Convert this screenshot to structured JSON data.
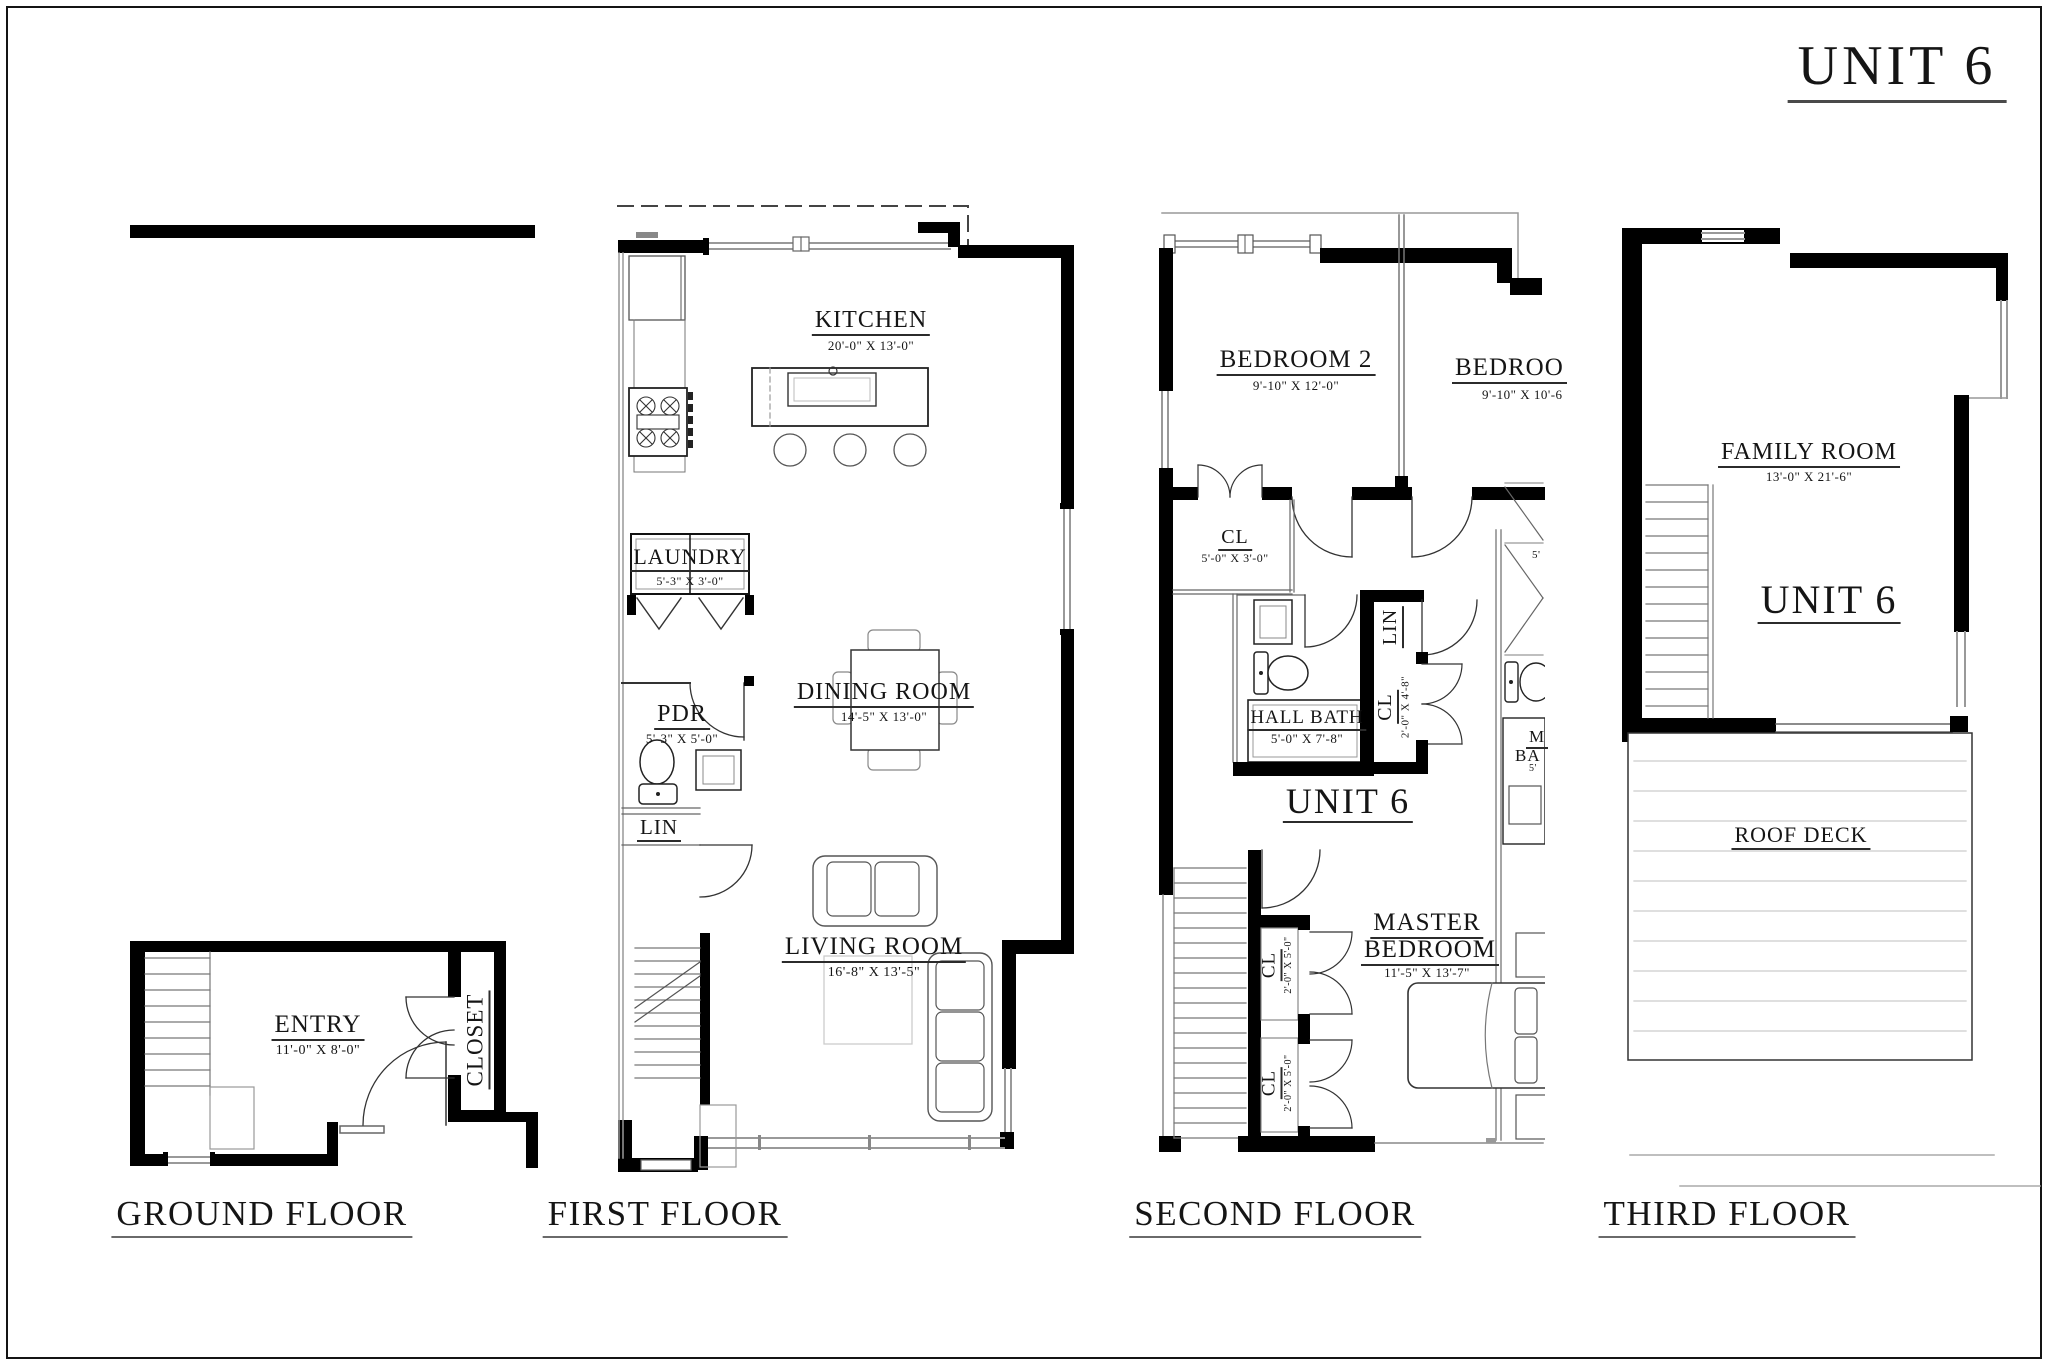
{
  "page": {
    "title": "UNIT 6"
  },
  "floors": {
    "ground": {
      "label": "GROUND FLOOR",
      "entry": {
        "name": "ENTRY",
        "dims": "11'-0\" X 8'-0\""
      },
      "closet": {
        "name": "CLOSET"
      }
    },
    "first": {
      "label": "FIRST FLOOR",
      "kitchen": {
        "name": "KITCHEN",
        "dims": "20'-0\" X 13'-0\""
      },
      "laundry": {
        "name": "LAUNDRY",
        "dims": "5'-3\" X 3'-0\""
      },
      "dining": {
        "name": "DINING ROOM",
        "dims": "14'-5\" X 13'-0\""
      },
      "powder": {
        "name": "PDR",
        "dims": "5'-3\" X 5'-0\""
      },
      "linen": {
        "name": "LIN"
      },
      "living": {
        "name": "LIVING ROOM",
        "dims": "16'-8\" X 13'-5\""
      }
    },
    "second": {
      "label": "SECOND FLOOR",
      "unit": "UNIT 6",
      "bedroom2": {
        "name": "BEDROOM 2",
        "dims": "9'-10\" X 12'-0\""
      },
      "bedroom3": {
        "name": "BEDROO",
        "dims": "9'-10\" X 10'-6"
      },
      "closet_hall": {
        "name": "CL",
        "dims": "5'-0\" X 3'-0\""
      },
      "hall_bath": {
        "name": "HALL BATH",
        "dims": "5'-0\" X 7'-8\""
      },
      "linen": {
        "name": "LIN"
      },
      "closet_mid": {
        "name": "CL",
        "dims": "2'-0\" X 4'-8\""
      },
      "master": {
        "line1": "MASTER",
        "line2": "BEDROOM",
        "dims": "11'-5\" X 13'-7\""
      },
      "closet_master1": {
        "name": "CL",
        "dims": "2'-0\" X 5'-0\""
      },
      "closet_master2": {
        "name": "CL",
        "dims": "2'-0\" X 5'-0\""
      },
      "master_bath_partial": {
        "line1": "M",
        "line2": "BA",
        "dim_top": "5'",
        "dim_bottom": "5'"
      }
    },
    "third": {
      "label": "THIRD FLOOR",
      "unit": "UNIT 6",
      "family": {
        "name": "FAMILY ROOM",
        "dims": "13'-0\" X 21'-6\""
      },
      "roof_deck": {
        "name": "ROOF DECK"
      }
    }
  }
}
